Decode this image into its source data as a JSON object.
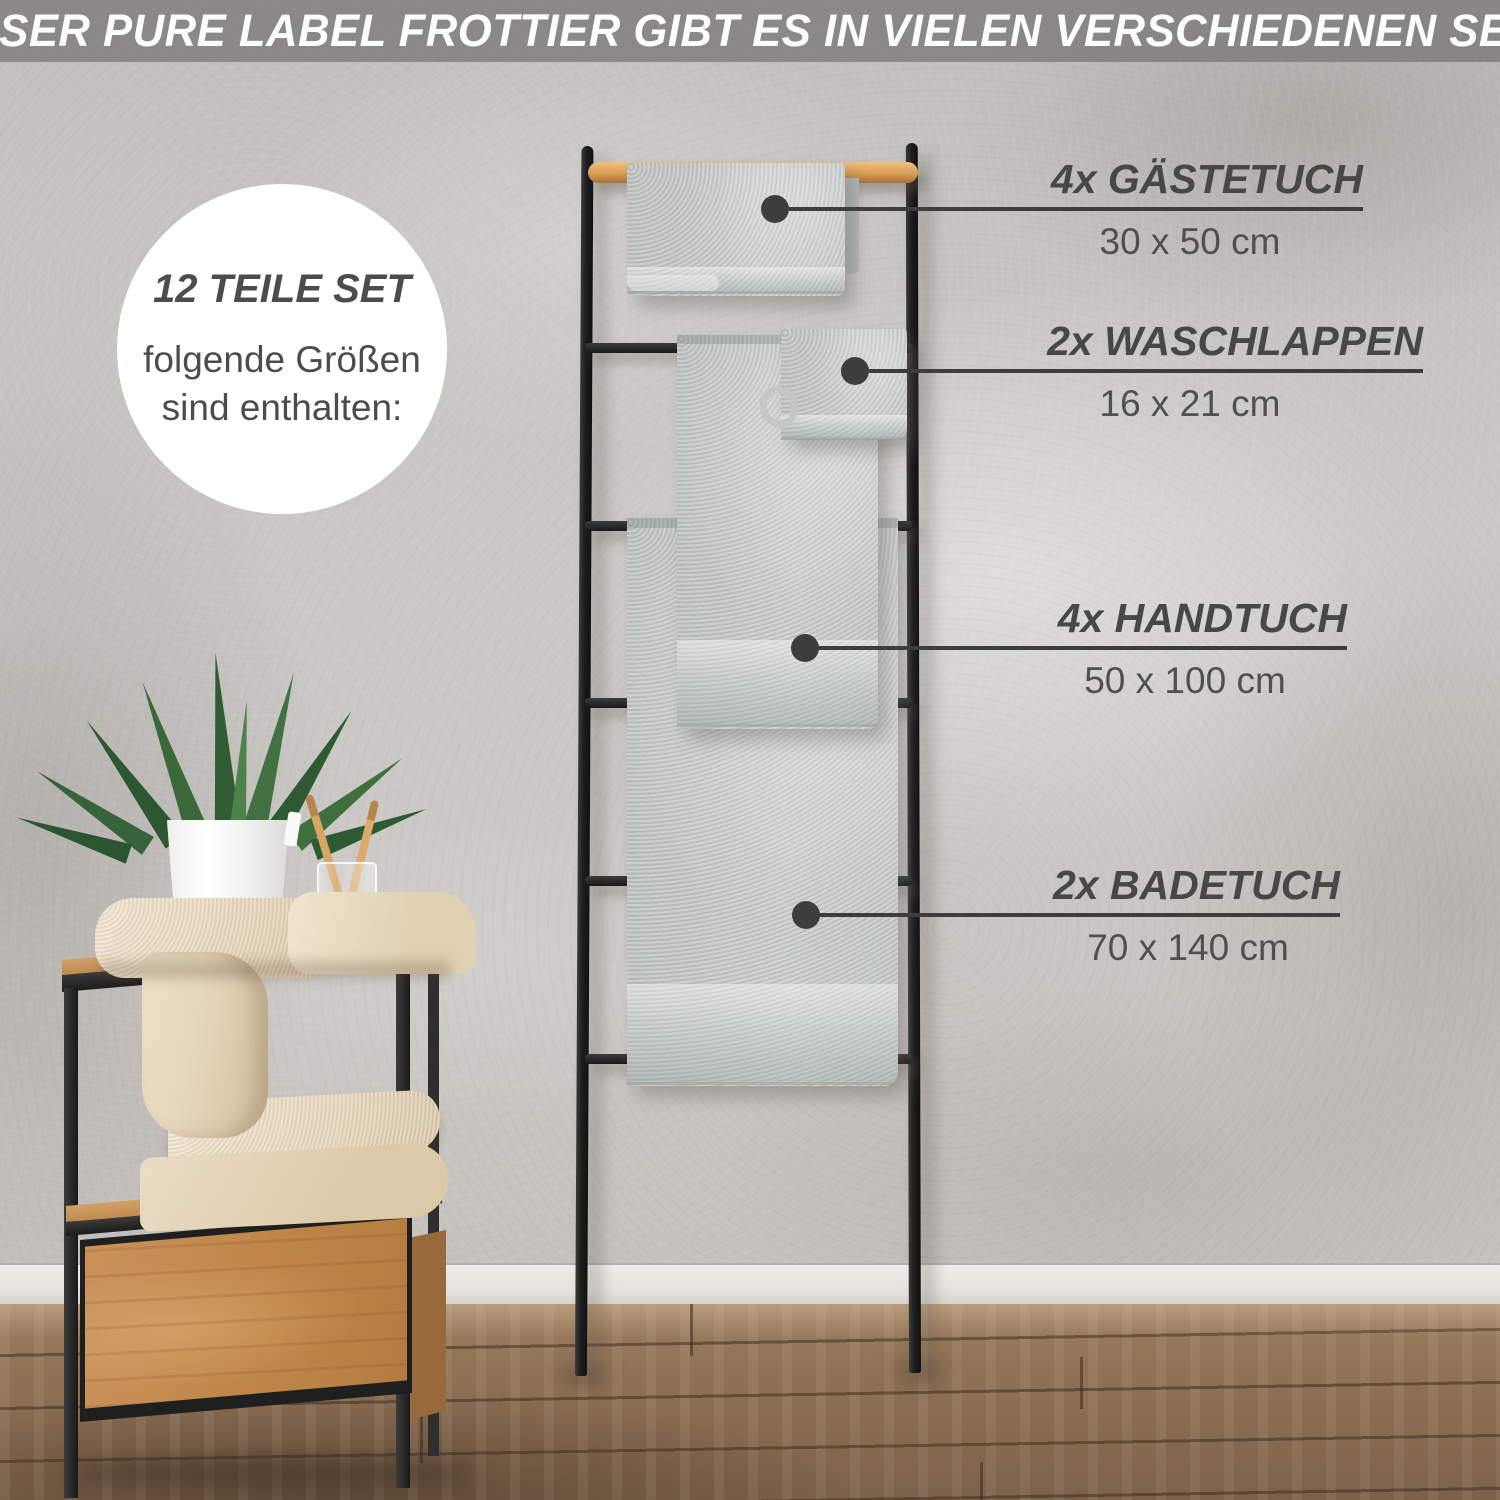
{
  "banner": {
    "text": "UNSER PURE LABEL FROTTIER GIBT ES IN VIELEN VERSCHIEDENEN SETS"
  },
  "badge": {
    "title": "12 TEILE SET",
    "subtitle_line1": "folgende Größen",
    "subtitle_line2": "sind enthalten:"
  },
  "callouts": [
    {
      "label": "4x GÄSTETUCH",
      "size": "30 x 50 cm"
    },
    {
      "label": "2x WASCHLAPPEN",
      "size": "16 x 21 cm"
    },
    {
      "label": "4x HANDTUCH",
      "size": "50 x 100 cm"
    },
    {
      "label": "2x BADETUCH",
      "size": "70 x 140 cm"
    }
  ],
  "colors": {
    "label_text": "#474747",
    "callout_line": "#3d3d3d",
    "banner_bg": "#7c7a78",
    "towel_gray": "#c6cac8",
    "bamboo": "#d89c55",
    "metal_black": "#1d1d1d",
    "wall_gray": "#c7c5c2",
    "floor_brown": "#8d7054"
  }
}
